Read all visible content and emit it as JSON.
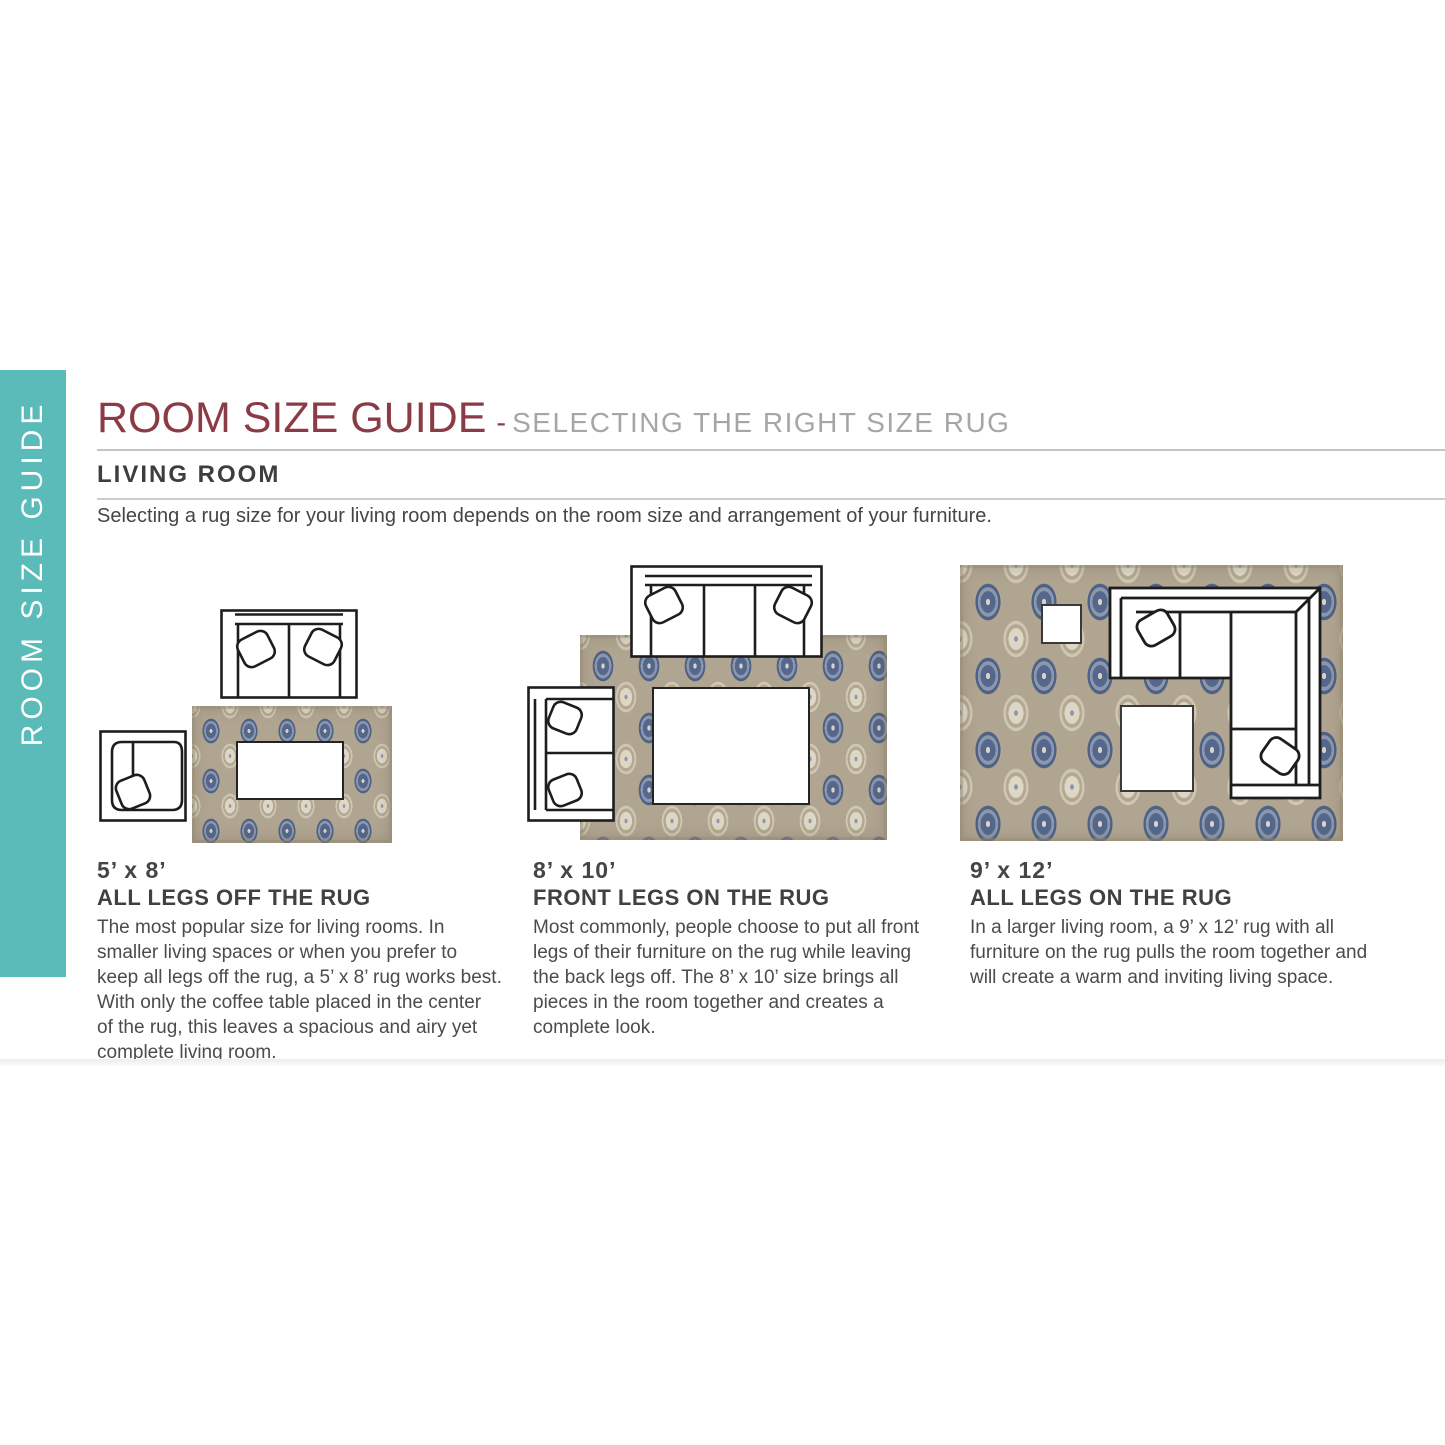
{
  "sidebar": {
    "label": "ROOM SIZE GUIDE"
  },
  "header": {
    "title": "ROOM SIZE GUIDE",
    "separator": "-",
    "subtitle": "SELECTING THE RIGHT SIZE RUG"
  },
  "section": {
    "heading": "LIVING ROOM",
    "intro": "Selecting a rug size for your living room depends on the room size and arrangement of your furniture."
  },
  "layouts": [
    {
      "size": "5’ x 8’",
      "rule": "ALL LEGS OFF THE RUG",
      "description": "The most popular size for living rooms. In smaller living spaces or when you prefer to keep all legs off the rug, a 5’ x 8’ rug works best. With only the coffee table placed in the center of the rug, this leaves a spacious and airy yet complete living room.",
      "furniture": [
        "loveseat sofa",
        "armchair",
        "coffee table",
        "5x8 patterned area rug"
      ]
    },
    {
      "size": "8’ x 10’",
      "rule": "FRONT LEGS ON THE RUG",
      "description": "Most commonly, people choose to put all front legs of their furniture on the rug while leaving the back legs off. The 8’ x 10’ size brings all pieces in the room together and creates a complete look.",
      "furniture": [
        "three-seat sofa",
        "loveseat sofa",
        "coffee table",
        "8x10 patterned area rug"
      ]
    },
    {
      "size": "9’ x 12’",
      "rule": "ALL LEGS ON THE RUG",
      "description": "In a larger living room, a 9’ x 12’ rug with all furniture on the rug pulls the room together and will create a warm and inviting living space.",
      "furniture": [
        "sectional sofa",
        "side table",
        "coffee table",
        "9x12 patterned area rug"
      ]
    }
  ],
  "colors": {
    "accent_teal": "#5ABBB9",
    "title_maroon": "#8A3B45",
    "subtitle_gray": "#A6A6A6",
    "heading_dark": "#3E3E3E",
    "body_gray": "#4B4B4B",
    "rug_blue": "#55678C",
    "rug_tan": "#B0A591",
    "rug_cream": "#DED7C6"
  }
}
